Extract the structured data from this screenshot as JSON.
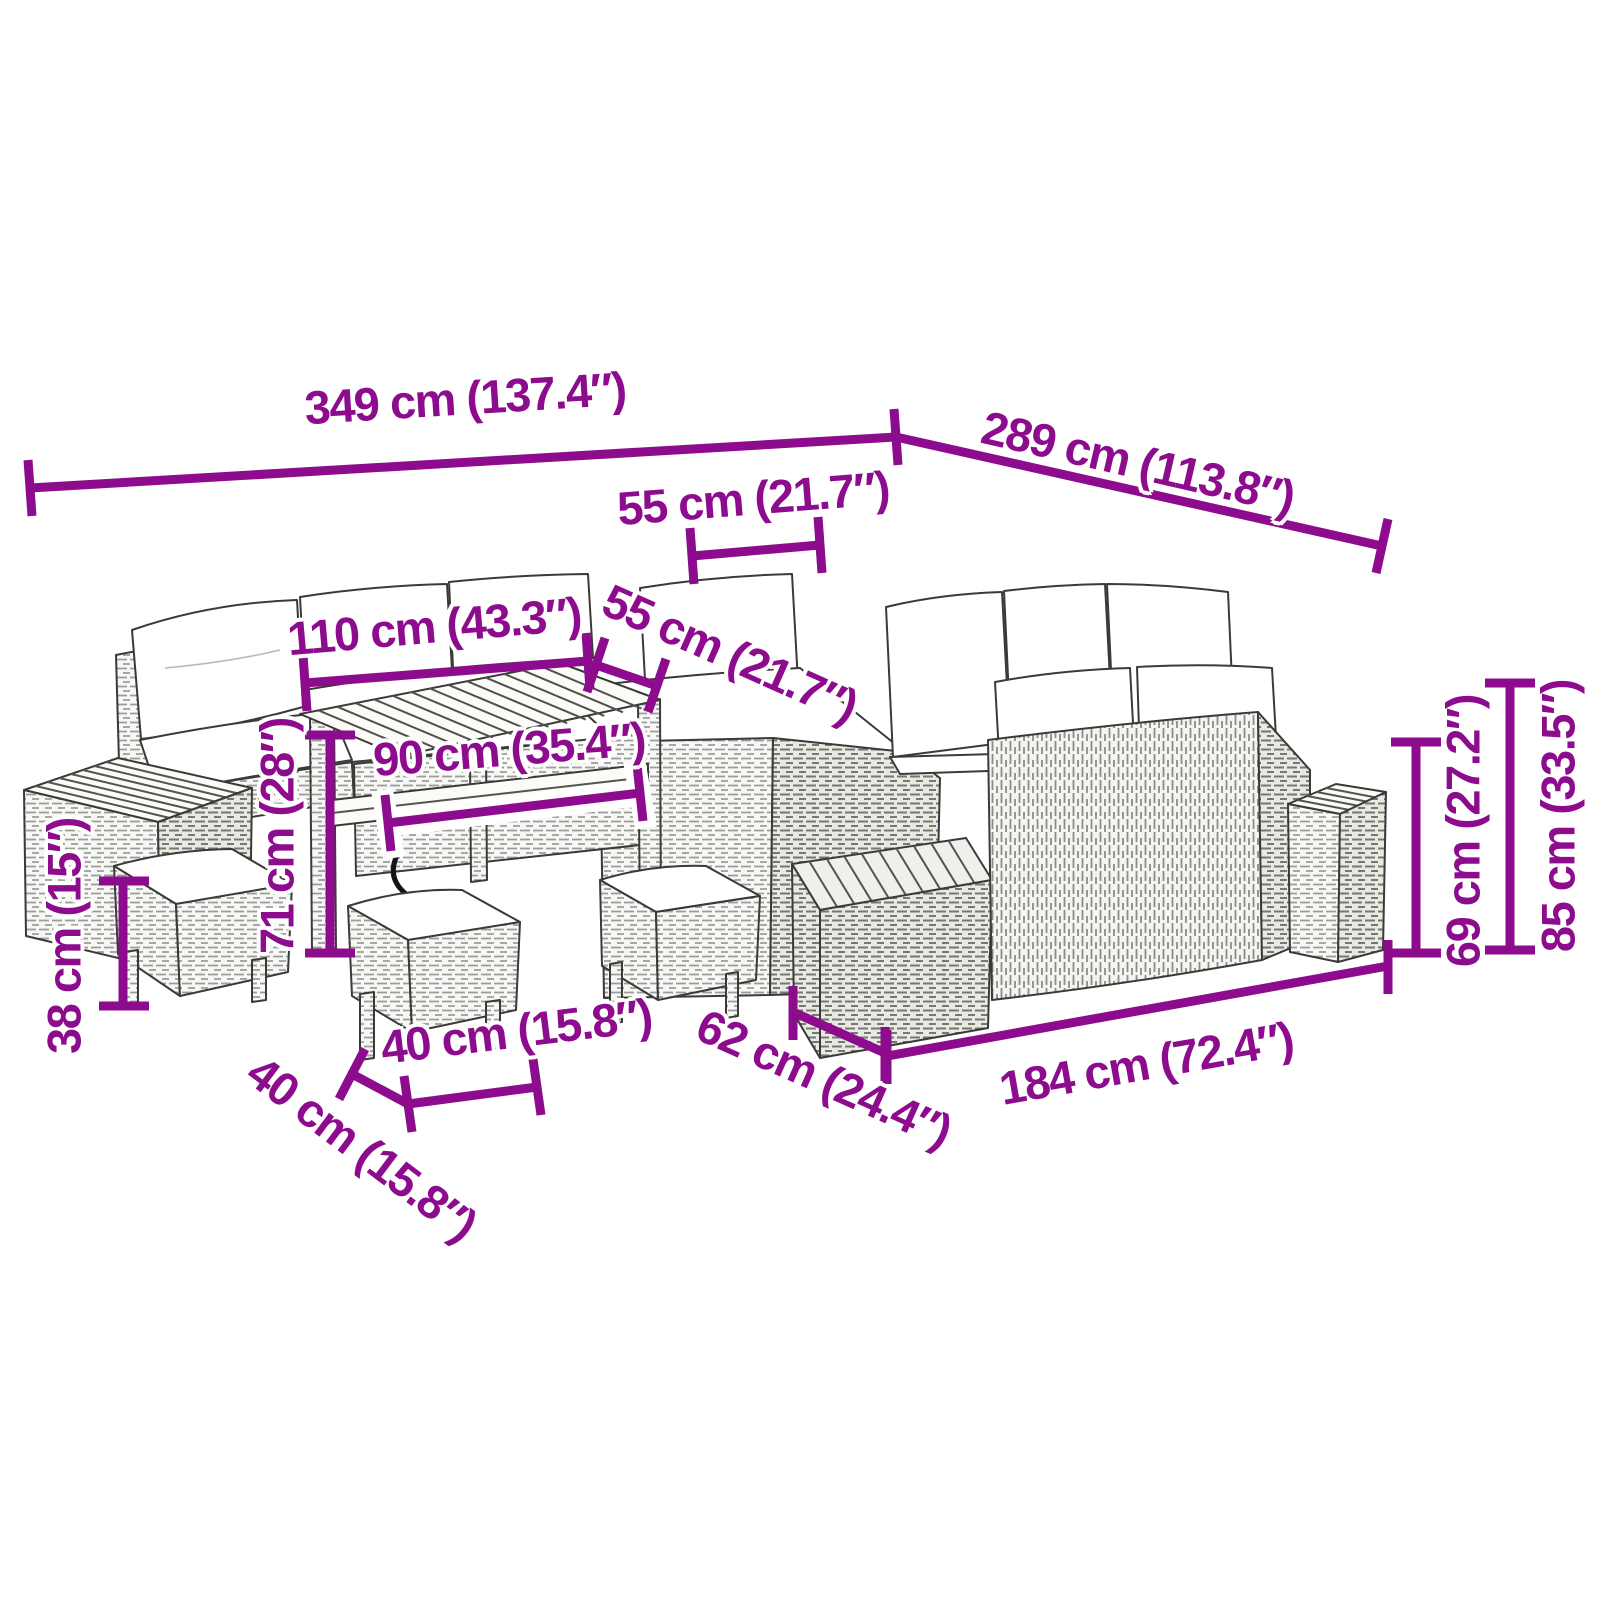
{
  "diagram": {
    "colors": {
      "dimension": "#8D0C8D",
      "line_art": "#3a3a38"
    },
    "dimensions": {
      "total_width": "349 cm (137.4″)",
      "total_depth": "289 cm (113.8″)",
      "back_seat_width": "55 cm (21.7″)",
      "table_length": "110 cm (43.3″)",
      "side_seat_width": "55 cm (21.7″)",
      "table_shelf_length": "90 cm (35.4″)",
      "table_height": "71 cm (28″)",
      "stool_height": "38 cm (15″)",
      "stool_width": "40 cm (15.8″)",
      "stool_depth": "40 cm (15.8″)",
      "bench_depth": "62 cm (24.4″)",
      "bench_length": "184 cm (72.4″)",
      "backrest_height": "69 cm (27.2″)",
      "total_height": "85 cm (33.5″)"
    }
  }
}
